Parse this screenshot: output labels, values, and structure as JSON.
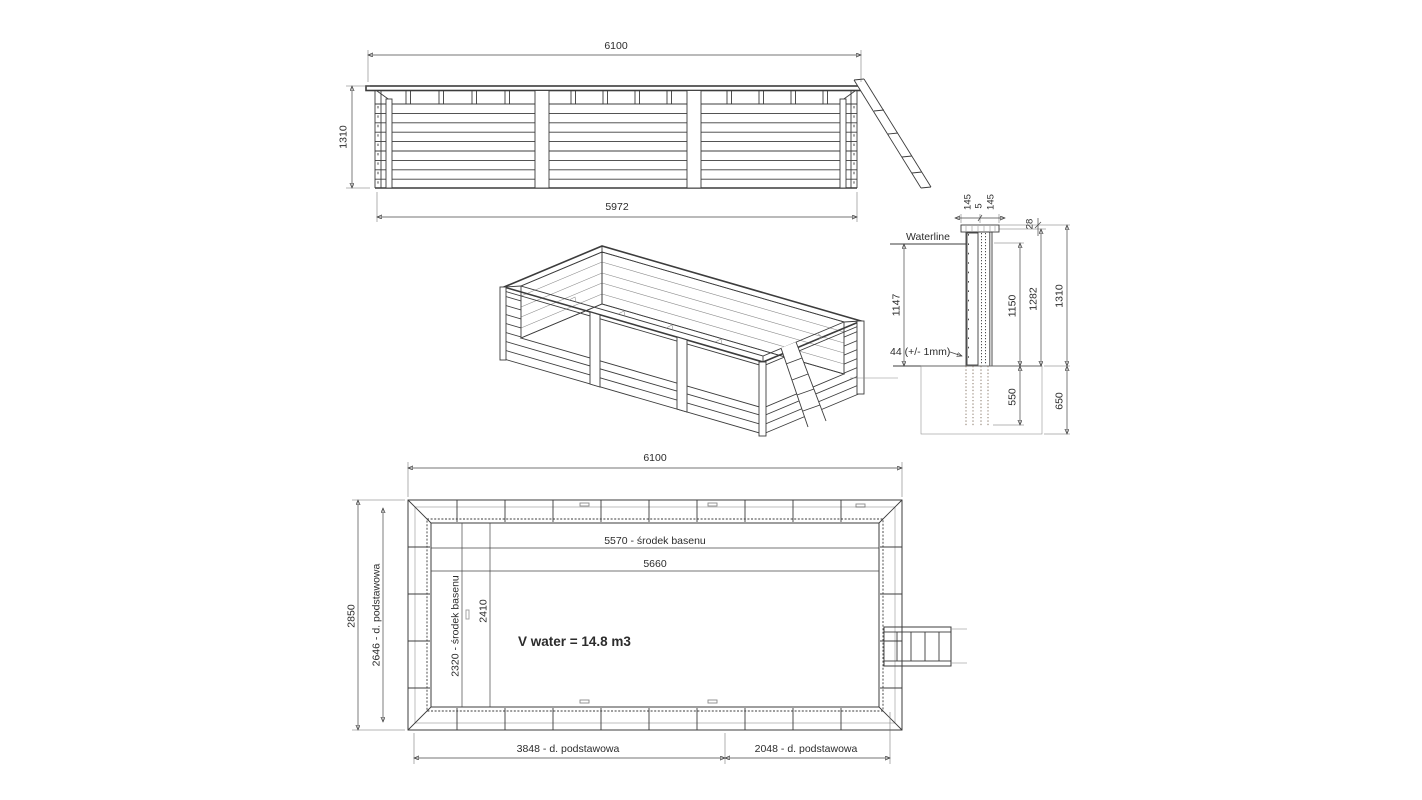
{
  "colors": {
    "waterline": "#2222b0",
    "wood_dot": "#bb9672",
    "wood_dot2": "#d2b291",
    "wood_accent": "#a2553a",
    "line": "#3c3c3c"
  },
  "elevation": {
    "width_top": "6100",
    "height_left": "1310",
    "width_bottom": "5972"
  },
  "section": {
    "cap_dims": [
      "145",
      "5",
      "145"
    ],
    "rim_offset": "28",
    "waterline_label": "Waterline",
    "water_depth": "1147",
    "height_inner": "1150",
    "height_mid": "1282",
    "height_total": "1310",
    "plank_note": "44 (+/- 1mm)",
    "embed_depth": "550",
    "pit_depth": "650"
  },
  "plan": {
    "width": "6100",
    "height": "2850",
    "base_height": "2646 - d. podstawowa",
    "pool_center_length": "5570 - środek basenu",
    "pool_length": "5660",
    "pool_center_width": "2320 - środek basenu",
    "pool_width": "2410",
    "volume": "V water = 14.8 m3",
    "base_length_1": "3848 - d. podstawowa",
    "base_length_2": "2048 - d. podstawowa"
  }
}
